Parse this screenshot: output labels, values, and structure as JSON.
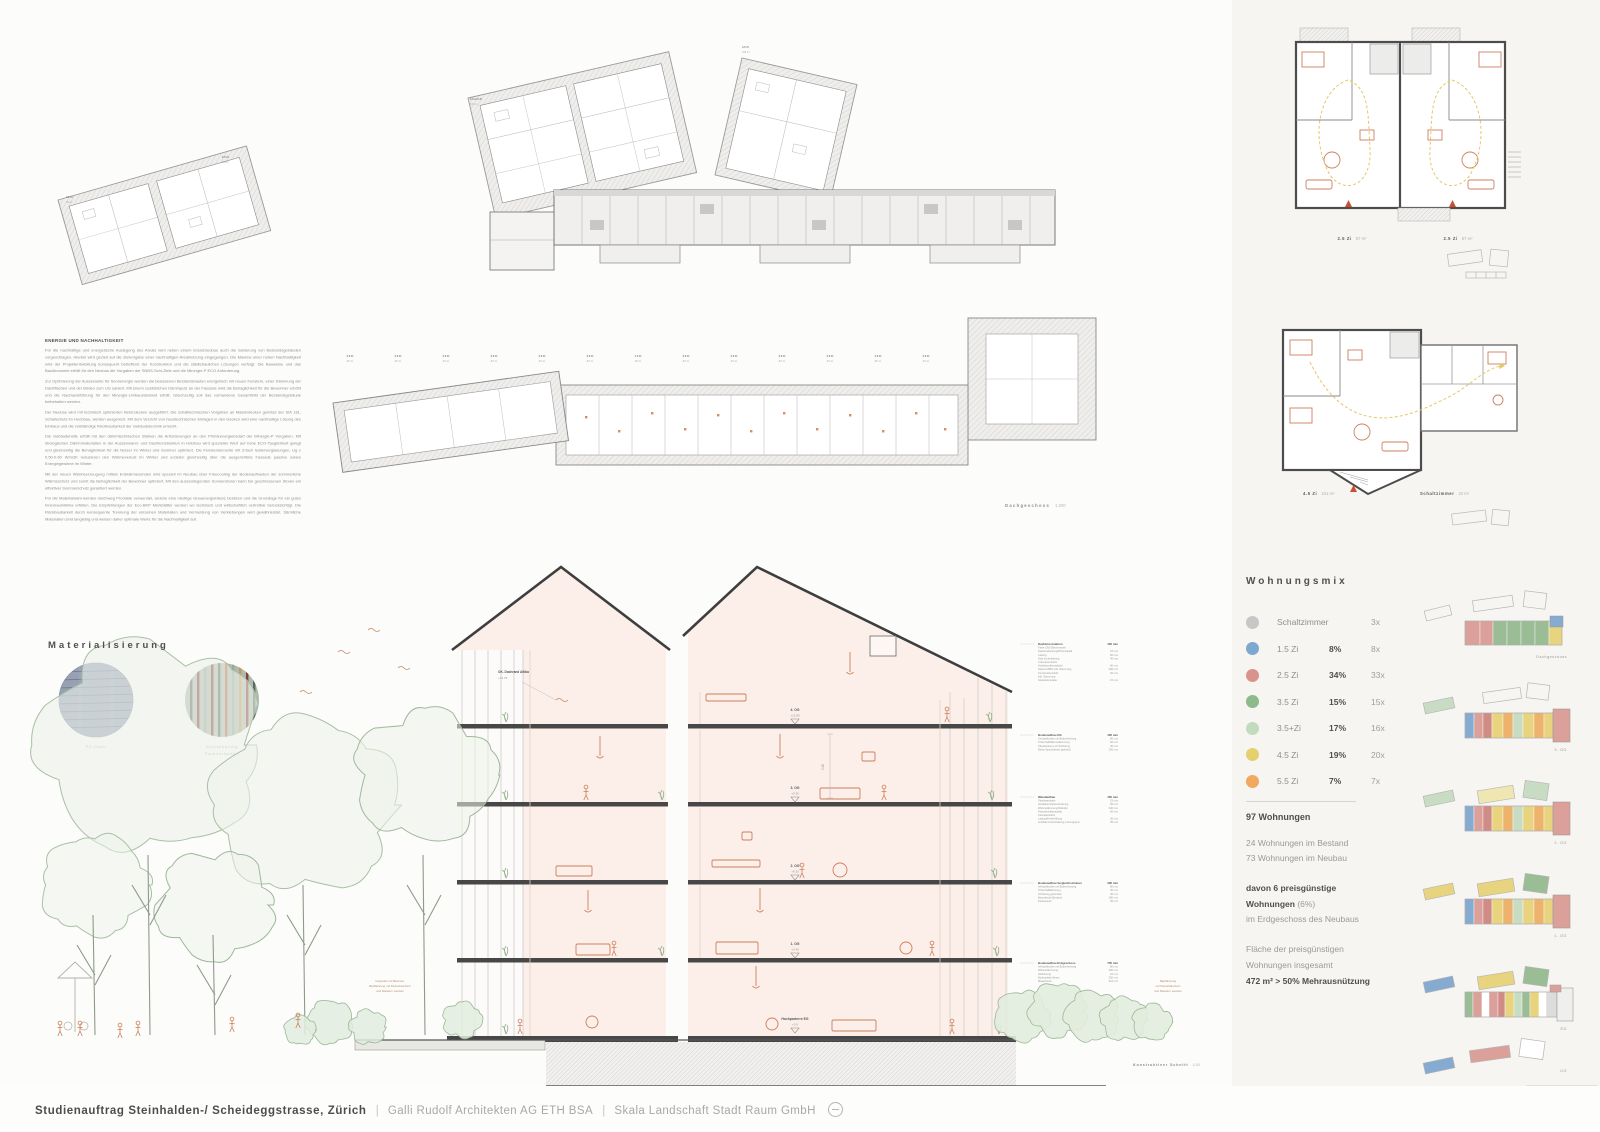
{
  "footer": {
    "title": "Studienauftrag Steinhalden-/ Scheideggstrasse, Zürich",
    "sep": "|",
    "partner1": "Galli Rudolf Architekten AG ETH BSA",
    "partner2": "Skala Landschaft Stadt Raum GmbH"
  },
  "energy": {
    "heading": "ENERGIE UND NACHHALTIGKEIT",
    "paragraphs": [
      "Für die nachhaltige und energetische Auslegung des Areals wird neben einem Ersatzneubau auch die Sanierung von Bestandsgebäuden vorgeschlagen. Hierbei wird gezielt auf die Zielvorgabe einer nachhaltigen Arealnutzung eingegangen. Die Maxime einer hohen Nachhaltigkeit wird der Projektentwicklung konsequent betreffend der Konstruktion und die städtebaulichen Lösungen verfolgt. Die Bauweise und das Bauökonomie erfüllt für den Neubau die Vorgaben der SNBS-Schl-Ziele und die Minergie-P ECO Anforderung.",
      "Zur Optimierung der Aussenseite für Sonnenergie werden die belassenen Bestandsbauten energetisch mit neuen Fenstern, einer Dämmung der Dachflächen und der Böden zum UG saniert. Mit einem zusätzlichen Dämmputz an der Fassade wird die Behaglichkeit für die Bewohner erhöht und die Nachweisführung für den Minergie-Umbaustandard erfüllt. Gleichzeitig soll das vorhandene Gesamtbild der Bestandsgebäude beibehalten werden.",
      "Der Neubau wird mit technisch optimierten Betondecken ausgeführt. Die schalltechnischen Vorgaben an Massivdecken gemäss der SIA 181, Schallschutz im Hochbau, werden ausgereizt. Mit dem Verzicht von haustechnischen Einlagen in den Decken wird eine nachhaltige Lösung des Einbaus und die vollständige Rückbaubarkeit der Gebäudetechnik erreicht.",
      "Die Gebäudehülle erfüllt mit den dämmtechnischen Stärken die Anforderungen an den Primärenergiebedarf der Minergie-P Vorgaben. Mit ökologischen Dämmmaterialien in der Aussenwand- und Dachkonstruktion in Holzbau wird spezieller Wert auf hohe ECO-Tauglichkeit gelegt und gleichzeitig die Behaglichkeit für die Nutzer im Winter und Sommer optimiert. Die Fensterelemente mit 3-fach Isolierverglasungen, Ug ≤ 0.50-0.60 W/m2K reduzieren den Wärmeverlust im Winter und erzielen gleichzeitig über die ausgerichtete Fassade passive solare Energiegewinne im Winter.",
      "Mit der neuen Wärmeerzeugung mittels Erdwärmesonden wird speziell im Neubau über Freecooling der Bodenaufbauten der sommerliche Wärmeschutz und somit die Behaglichkeit der Bewohner optimiert. Mit den aussenliegenden Sonnenstoren kann bei geschlossenen Storen ein effektiver Sommerschutz garantiert werden.",
      "Für die Materialwahl werden durchweg Produkte verwendet, welche eine niedrige Grauenergiebilanz besitzen und die Grundlage für ein gutes Innenraumklima erfüllen. Die Empfehlungen der Eco-BKP Merkblätter werden wo technisch und wirtschaftlich vertretbar berücksichtigt. Die Rückbaubarkeit durch konsequente Trennung der einzelnen Materialien und Vermeidung von Verklebungen wird gewährleistet. Sämtliche Materialien sind langlebig und weisen daher optimale Werte für die Nachhaltigkeit auf."
    ]
  },
  "materialisierung": {
    "heading": "Materialisierung",
    "label1": "PV-Dach",
    "label2a": "Holzschalung",
    "label2b": "Farbvarianten"
  },
  "plans": {
    "dachgeschoss_caption": "Dachgeschoss",
    "dachgeschoss_scale": "1:200",
    "unit_micro_labels": [
      [
        "2.5 Zi",
        "60 m²"
      ],
      [
        "2.5 Zi",
        "60 m²"
      ],
      [
        "2.5 Zi",
        "64 m²"
      ],
      [
        "3.5 Zi",
        "84 m²"
      ],
      [
        "2.5 Zi",
        "64 m²"
      ],
      [
        "3.5 Zi",
        "84 m²"
      ],
      [
        "1.5 Zi",
        "39 m²"
      ],
      [
        "3.5 Zi",
        "84 m²"
      ],
      [
        "2.5 Zi",
        "64 m²"
      ],
      [
        "3.5 Zi",
        "84 m²"
      ],
      [
        "2.5 Zi",
        "64 m²"
      ],
      [
        "4.5 Zi",
        "96 m²"
      ],
      [
        "2.5 Zi",
        "64 m²"
      ]
    ],
    "top_plan_labels": [
      [
        "2.5 Zi",
        "65 m²"
      ],
      [
        "2.5 Zi",
        "69 m²"
      ],
      [
        "2.5+2.5 Zi",
        "115 m²"
      ],
      [
        "4.5 Zi",
        "108 m²"
      ]
    ]
  },
  "section": {
    "ok_label": "OK. Dachrand Attika",
    "ok_level": "+13.78",
    "dim": "2.60",
    "floors": [
      {
        "name": "4. OG",
        "level": "+12.80"
      },
      {
        "name": "3. OG",
        "level": "+9.30"
      },
      {
        "name": "2. OG",
        "level": "+6.30"
      },
      {
        "name": "1. OG",
        "level": "+3.40"
      },
      {
        "name": "Hochparterre EG",
        "level": "+0.5"
      }
    ],
    "left_note": [
      "Vorgarten mit Bäumen,",
      "Bepflanzung mit Kleinsträuchern",
      "und Stauden, Hecken"
    ],
    "right_note": [
      "Bepflanzung",
      "mit Kleinsträuchern",
      "und Stauden, Hecken"
    ],
    "caption": "Konstruktiver Schnitt",
    "caption_scale": "1:50",
    "construction_blocks": [
      {
        "title": "Dachkonstruktion",
        "total": "400 mm",
        "layers": [
          [
            "Falze CNS Blechmantel",
            ""
          ],
          [
            "Dacheindeckung/Photovoltaik",
            "15 mm"
          ],
          [
            "Lattung",
            "60 mm"
          ],
          [
            "Holz Konterlattung",
            "40 mm"
          ],
          [
            "Unterspannbahn",
            ""
          ],
          [
            "Holzfaserdämmplatte",
            "60 mm"
          ],
          [
            "Sparren/BSH inkl. Dämmung",
            "260 mm"
          ],
          [
            "Konstruktionsholz",
            "20 mm"
          ],
          [
            "inkl. Dämmung",
            ""
          ],
          [
            "Gipskartonplatte",
            "15 mm"
          ]
        ]
      },
      {
        "title": "Bodenaufbau OG",
        "total": "400 mm",
        "layers": [
          [
            "Anhydritboden mit Bodenheizung",
            "80 mm"
          ],
          [
            "Trittschall/Wärmedämmung",
            "60 mm"
          ],
          [
            "Überdeckung mit Schüttung",
            "30 mm"
          ],
          [
            "Beton-Spanndecke (gefräst)",
            "230 mm"
          ]
        ]
      },
      {
        "title": "Wandaufbau",
        "total": "450 mm",
        "layers": [
          [
            "Gipsfaserplatte",
            "15 mm"
          ],
          [
            "Installationsebene/Lattung",
            "50 mm"
          ],
          [
            "Wärmedämmung/Ständer",
            "240 mm"
          ],
          [
            "Holzweichfaserplatte",
            "60 mm"
          ],
          [
            "Fassadenbahn",
            ""
          ],
          [
            "Lattung/Hinterlüftung",
            "50 mm"
          ],
          [
            "vertikale Holzschalung (vorvergraut)",
            "35 mm"
          ]
        ]
      },
      {
        "title": "Bodenaufbau Vergleichszimmer",
        "total": "390 mm",
        "layers": [
          [
            "Anhydritboden mit Bodenheizung",
            "80 mm"
          ],
          [
            "Trittschalldämmung",
            "40 mm"
          ],
          [
            "Schüttung gebunden",
            "60 mm"
          ],
          [
            "Betondecke Bestand",
            "180 mm"
          ],
          [
            "Deckenputz",
            "30 mm"
          ]
        ]
      },
      {
        "title": "Bodenaufbau Erdgeschoss",
        "total": "750 mm",
        "layers": [
          [
            "Anhydritboden mit Bodenheizung",
            "80 mm"
          ],
          [
            "Wärmedämmung",
            "200 mm"
          ],
          [
            "Abdichtung",
            "10 mm"
          ],
          [
            "Bodenplatte Beton",
            "250 mm"
          ],
          [
            "Magerbeton",
            "210 mm"
          ]
        ]
      }
    ]
  },
  "unit_plans": {
    "top": [
      {
        "label": "2.5 Zi",
        "area": "67 m²"
      },
      {
        "label": "2.5 Zi",
        "area": "67 m²"
      }
    ],
    "bottom": [
      {
        "label": "4.5 Zi",
        "area": "101 m²"
      },
      {
        "label": "Schaltzimmer",
        "area": "22 m²"
      }
    ]
  },
  "wohnungsmix": {
    "heading": "Wohnungsmix",
    "rows": [
      {
        "color": "#c7c7c7",
        "label": "Schaltzimmer",
        "pct": "",
        "count": "3x"
      },
      {
        "color": "#7ea9cf",
        "label": "1.5 Zi",
        "pct": "8%",
        "count": "8x"
      },
      {
        "color": "#d9938d",
        "label": "2.5 Zi",
        "pct": "34%",
        "count": "33x"
      },
      {
        "color": "#8cba8a",
        "label": "3.5 Zi",
        "pct": "15%",
        "count": "15x"
      },
      {
        "color": "#c2dbbf",
        "label": "3.5+Zi",
        "pct": "17%",
        "count": "16x"
      },
      {
        "color": "#e5d06f",
        "label": "4.5 Zi",
        "pct": "19%",
        "count": "20x"
      },
      {
        "color": "#f0a95f",
        "label": "5.5 Zi",
        "pct": "7%",
        "count": "7x"
      }
    ],
    "total": "97 Wohnungen",
    "line1": "24 Wohnungen im Bestand",
    "line2": "73 Wohnungen im Neubau",
    "bold1": "davon 6 preisgünstige",
    "bold2": "Wohnungen",
    "bold2b": " (6%)",
    "line3": "im Erdgeschoss des Neubaus",
    "line4": "Fläche der preisgünstigen",
    "line5": "Wohnungen insgesamt",
    "bold3": "472 m² > 50% Mehrausnützung"
  },
  "floor_stack": {
    "labels": [
      "Dachgeschoss",
      "3. OG",
      "2. OG",
      "1. OG",
      "EG",
      "UG"
    ],
    "palette": {
      "pink": "#dca09a",
      "red": "#cf8b85",
      "green": "#9bbd95",
      "lgreen": "#c8dcc4",
      "yellow": "#e8d47e",
      "orange": "#edb36c",
      "blue": "#85abd0",
      "paleyellow": "#f0e6b2",
      "gray": "#dcdcdc",
      "white": "#ffffff"
    },
    "rows": [
      {
        "segs": [
          [
            "pink",
            15
          ],
          [
            "pink",
            13
          ],
          [
            "green",
            14
          ],
          [
            "green",
            14
          ],
          [
            "green",
            14
          ],
          [
            "green",
            14
          ],
          [
            "yellow",
            13
          ]
        ]
      },
      {
        "segs": [
          [
            "blue",
            9
          ],
          [
            "pink",
            9
          ],
          [
            "red",
            9
          ],
          [
            "yellow",
            11
          ],
          [
            "orange",
            10
          ],
          [
            "lgreen",
            10
          ],
          [
            "yellow",
            11
          ],
          [
            "orange",
            10
          ],
          [
            "yellow",
            9
          ]
        ]
      },
      {
        "segs": [
          [
            "blue",
            9
          ],
          [
            "pink",
            9
          ],
          [
            "red",
            9
          ],
          [
            "yellow",
            11
          ],
          [
            "orange",
            10
          ],
          [
            "lgreen",
            10
          ],
          [
            "yellow",
            11
          ],
          [
            "orange",
            10
          ],
          [
            "yellow",
            9
          ]
        ]
      },
      {
        "segs": [
          [
            "blue",
            9
          ],
          [
            "pink",
            9
          ],
          [
            "red",
            9
          ],
          [
            "yellow",
            11
          ],
          [
            "orange",
            10
          ],
          [
            "lgreen",
            10
          ],
          [
            "yellow",
            11
          ],
          [
            "orange",
            10
          ],
          [
            "yellow",
            9
          ]
        ]
      },
      {
        "segs": [
          [
            "green",
            8
          ],
          [
            "pink",
            9
          ],
          [
            "white",
            7
          ],
          [
            "pink",
            9
          ],
          [
            "red",
            7
          ],
          [
            "yellow",
            9
          ],
          [
            "lgreen",
            8
          ],
          [
            "green",
            8
          ],
          [
            "yellow",
            9
          ],
          [
            "white",
            7
          ],
          [
            "gray",
            11
          ]
        ]
      },
      {
        "segs": []
      }
    ]
  }
}
